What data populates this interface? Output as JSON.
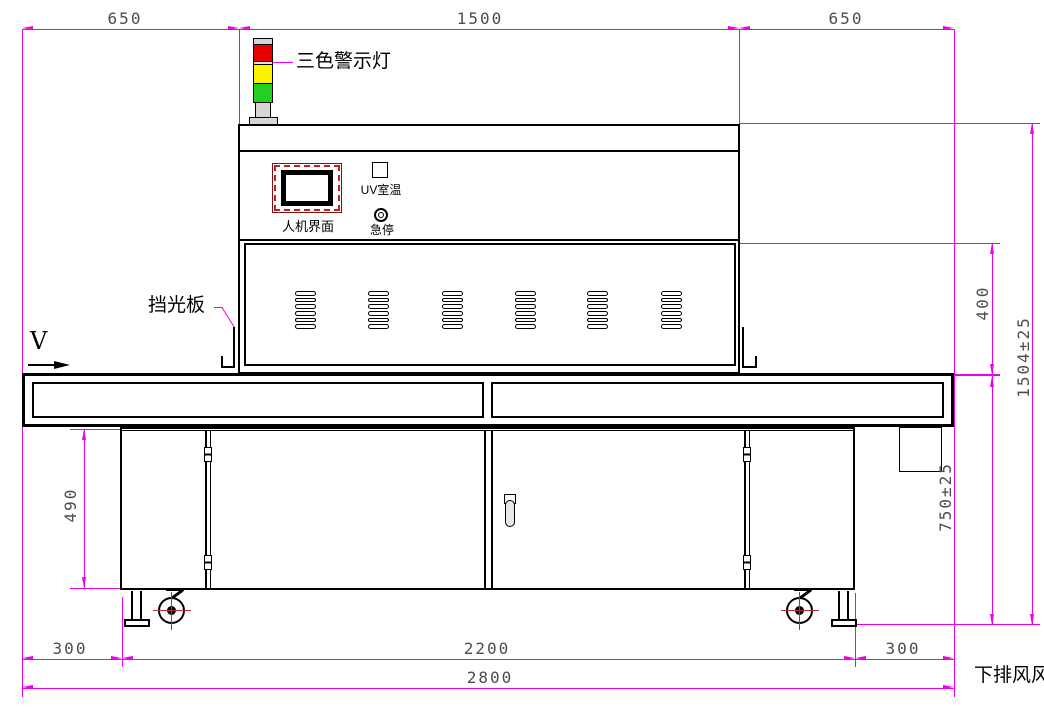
{
  "drawing": {
    "machine_labels": {
      "tower_light": "三色警示灯",
      "hmi": "人机界面",
      "uv_room_temp": "UV室温",
      "emergency_stop": "急停",
      "light_shield": "挡光板",
      "direction": "V",
      "bottom_exhaust": "下排风风"
    },
    "dimensions": {
      "top": [
        "650",
        "1500",
        "650"
      ],
      "bottom_300_left": "300",
      "bottom_2200": "2200",
      "bottom_300_right": "300",
      "bottom_2800": "2800",
      "left_490": "490",
      "right_400": "400",
      "right_750": "750±25",
      "right_1504": "1504±25"
    },
    "colors": {
      "dimension_line": "#EE00EE",
      "dimension_text": "#4D4D4D",
      "outline": "#000000",
      "tower_red": "#E60000",
      "tower_yellow": "#FFF200",
      "tower_green": "#21D021",
      "tower_gray": "#D6D6D6",
      "hmi_frame_red": "#C02020",
      "caster_center_mark": "#B03030"
    }
  }
}
